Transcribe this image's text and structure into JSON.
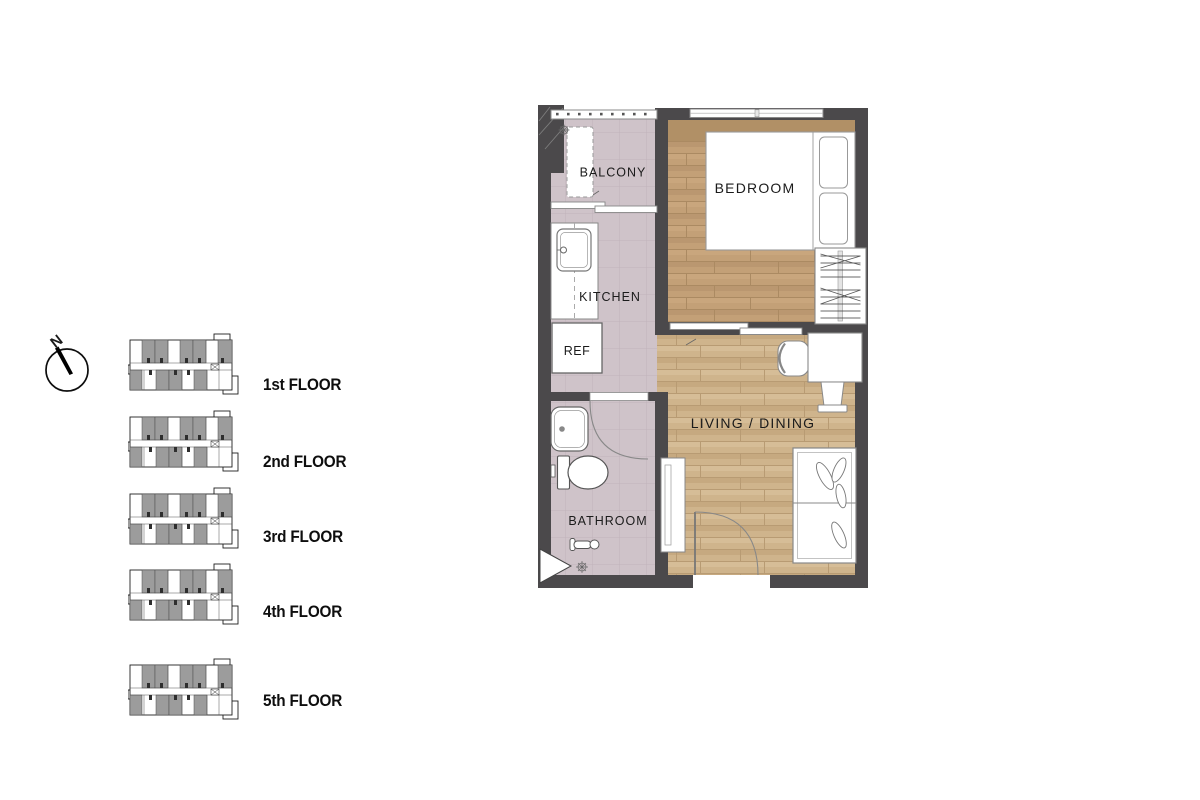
{
  "compass": {
    "label": "N"
  },
  "floor_list": {
    "floors": [
      {
        "label": "1st FLOOR"
      },
      {
        "label": "2nd FLOOR"
      },
      {
        "label": "3rd FLOOR"
      },
      {
        "label": "4th FLOOR"
      },
      {
        "label": "5th FLOOR"
      }
    ]
  },
  "unit_plan": {
    "labels": {
      "balcony": "BALCONY",
      "bedroom": "BEDROOM",
      "kitchen": "KITCHEN",
      "refrigerator": "REF",
      "living_dining": "LIVING / DINING",
      "bathroom": "BATHROOM"
    }
  },
  "colors": {
    "wall": "#4b494b",
    "tile_floor": "#cfc3c9",
    "tile_grid": "#c0b3ba",
    "bedroom_wood": "#c3a077",
    "bedroom_counter_band": "#b19066",
    "living_wood": "#cfb48c",
    "thumbnail_unit_gray": "#9c9c9c",
    "label_text": "#1b1b1b"
  }
}
